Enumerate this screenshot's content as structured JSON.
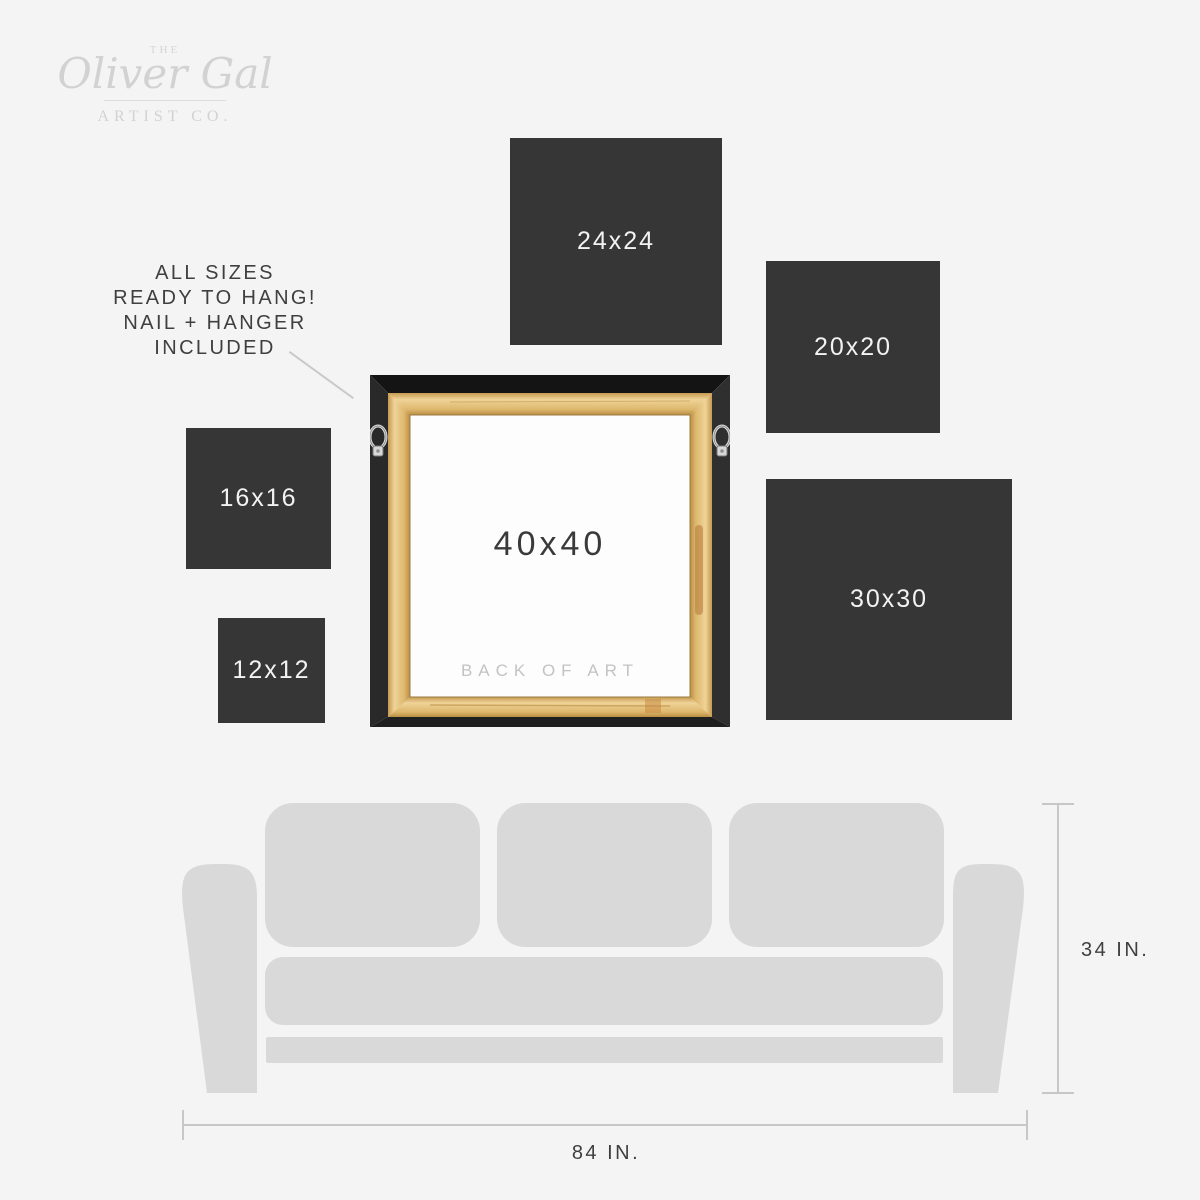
{
  "brand": {
    "the": "THE",
    "name": "Oliver Gal",
    "subtitle": "ARTIST CO."
  },
  "note": {
    "text": "ALL SIZES\nREADY TO HANG!\nNAIL + HANGER\nINCLUDED"
  },
  "sizes": {
    "squares": [
      {
        "label": "24x24"
      },
      {
        "label": "20x20"
      },
      {
        "label": "16x16"
      },
      {
        "label": "12x12"
      },
      {
        "label": "30x30"
      }
    ],
    "frame": {
      "label": "40x40",
      "caption": "BACK OF ART"
    }
  },
  "sofa": {
    "height_label": "34 IN.",
    "width_label": "84 IN."
  },
  "colors": {
    "background": "#f4f4f4",
    "size_square": "#363636",
    "size_square_label": "#f2f2f2",
    "sofa": "#d9d9d9",
    "dimension_line": "#c7c7c7",
    "dark_text": "#3f3f3f",
    "logo_gray": "#d2d2d2",
    "frame_black": "#1c1c1c",
    "frame_wood": "#e2c07c",
    "canvas_back": "#fdfdfd",
    "caption_gray": "#c3c3c3"
  }
}
